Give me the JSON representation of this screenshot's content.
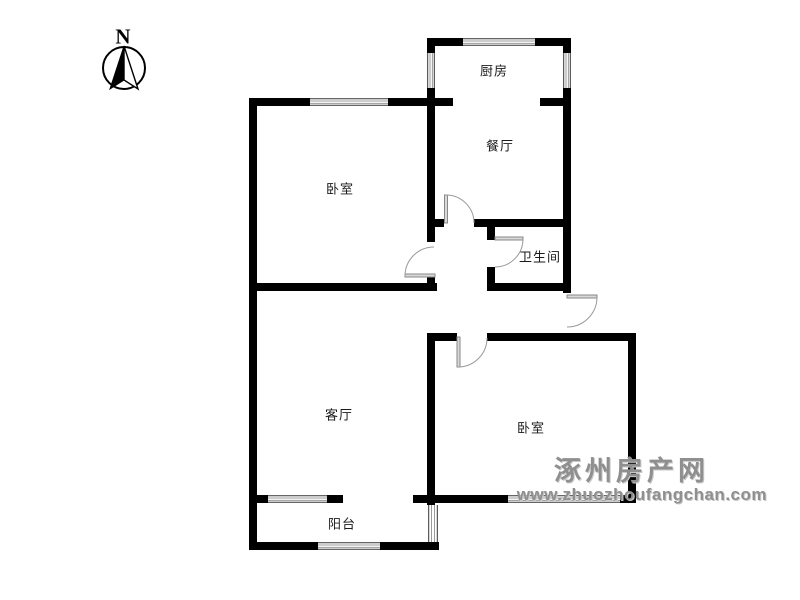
{
  "canvas": {
    "width": 800,
    "height": 600,
    "background": "#ffffff"
  },
  "compass": {
    "label": "N"
  },
  "rooms": [
    {
      "id": "kitchen",
      "label": "厨房"
    },
    {
      "id": "dining-room",
      "label": "餐厅"
    },
    {
      "id": "bedroom-left",
      "label": "卧室"
    },
    {
      "id": "bathroom",
      "label": "卫生间"
    },
    {
      "id": "living-room",
      "label": "客厅"
    },
    {
      "id": "bedroom-right",
      "label": "卧室"
    },
    {
      "id": "balcony",
      "label": "阳台"
    }
  ],
  "watermark": {
    "site_name": "涿州房产网",
    "site_url": "www.zhuozhoufangchan.com",
    "color": "#8f8f8f"
  },
  "colors": {
    "wall": "#000000",
    "window_line": "#999999",
    "door_arc": "#999999",
    "label_text": "#1a1a1a"
  }
}
